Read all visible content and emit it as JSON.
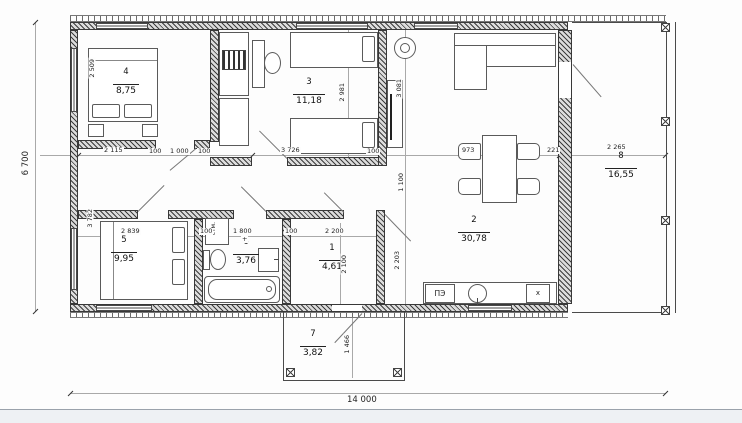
{
  "title": "floor-plan",
  "rooms": [
    {
      "num": "1",
      "area": "4,61"
    },
    {
      "num": "2",
      "area": "30,78"
    },
    {
      "num": "3",
      "area": "11,18"
    },
    {
      "num": "4",
      "area": "8,75"
    },
    {
      "num": "5",
      "area": "9,95"
    },
    {
      "num": "6",
      "area": "3,76"
    },
    {
      "num": "7",
      "area": "3,82"
    },
    {
      "num": "8",
      "area": "16,55"
    }
  ],
  "dims": {
    "overall_width": "14 000",
    "overall_height": "6 700",
    "mid_row": [
      "2 115",
      "100",
      "1 000",
      "100",
      "3 726",
      "100",
      "973",
      "221",
      "2 265"
    ],
    "low_row": [
      "2 839",
      "100",
      "1 800",
      "100",
      "2 200"
    ],
    "plus_mark": "+",
    "v_room4": "2 509",
    "v_room5": "3 782",
    "v_room3": "2 981",
    "v_hall_top": "3 081",
    "v_corridor": "1 100",
    "v_kitchen": "2 203",
    "v_room1": "2 100",
    "v_porch": "1 466"
  },
  "fixtures": {
    "washer": "стм.",
    "stove": "ПЭ",
    "fridge": "х"
  },
  "colors": {
    "wall": "#3d3d3d",
    "line": "#4a4a4a",
    "paper": "#fdfdfd"
  }
}
